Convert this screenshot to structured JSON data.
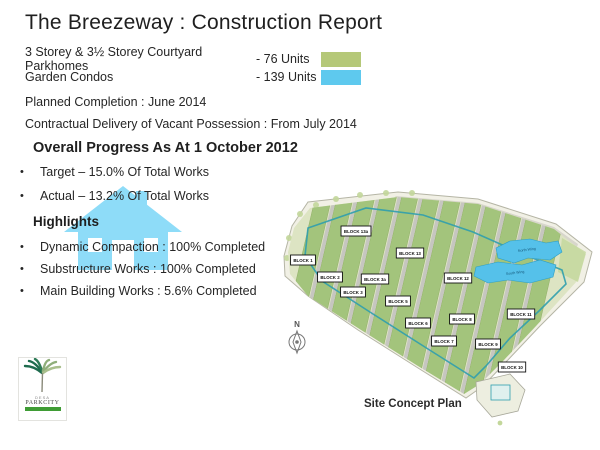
{
  "title": "The Breezeway : Construction Report",
  "legend": {
    "rows": [
      {
        "label": "3 Storey & 3½ Storey Courtyard Parkhomes",
        "units": "- 76 Units",
        "color": "#b5c878"
      },
      {
        "label": "Garden Condos",
        "units": "- 139 Units",
        "color": "#5ec9ee"
      }
    ]
  },
  "info": {
    "planned_completion": "Planned Completion : June 2014",
    "contractual_delivery": "Contractual Delivery of Vacant Possession :  From July 2014"
  },
  "progress": {
    "heading": "Overall Progress As At 1 October 2012",
    "bullets": [
      "Target – 15.0% Of Total Works",
      "Actual – 13.2% Of Total Works"
    ]
  },
  "highlights": {
    "heading": "Highlights",
    "bullets": [
      "Dynamic Compaction : 100% Completed",
      "Substructure Works : 100% Completed",
      "Main Building Works : 5.6% Completed"
    ]
  },
  "watermark": {
    "icon": "house-icon",
    "color": "#8edcf8"
  },
  "logo": {
    "line1": "DESA",
    "line2": "PARKCITY"
  },
  "map": {
    "caption": "Site Concept Plan",
    "car_park_label": "Car Park / Facility Deck",
    "compass_label": "N",
    "wings": [
      "North Wing",
      "South Wing"
    ],
    "blocks": [
      {
        "label": "BLOCK 13a",
        "x": 78,
        "y": 45
      },
      {
        "label": "BLOCK 13",
        "x": 132,
        "y": 67
      },
      {
        "label": "BLOCK 1",
        "x": 25,
        "y": 74
      },
      {
        "label": "BLOCK 2",
        "x": 52,
        "y": 91
      },
      {
        "label": "BLOCK 3a",
        "x": 97,
        "y": 93
      },
      {
        "label": "BLOCK 12",
        "x": 180,
        "y": 92
      },
      {
        "label": "BLOCK 3",
        "x": 75,
        "y": 106
      },
      {
        "label": "BLOCK 5",
        "x": 120,
        "y": 115
      },
      {
        "label": "BLOCK 11",
        "x": 243,
        "y": 128
      },
      {
        "label": "BLOCK 6",
        "x": 140,
        "y": 137
      },
      {
        "label": "BLOCK 8",
        "x": 184,
        "y": 133
      },
      {
        "label": "BLOCK 7",
        "x": 166,
        "y": 155
      },
      {
        "label": "BLOCK 9",
        "x": 210,
        "y": 158
      },
      {
        "label": "BLOCK 10",
        "x": 234,
        "y": 181
      }
    ],
    "colors": {
      "parkhomes_green": "#a3c47c",
      "condo_blue": "#55c1ea",
      "boundary_teal": "#2f9eae",
      "site_bg": "#f1f0e5"
    }
  }
}
